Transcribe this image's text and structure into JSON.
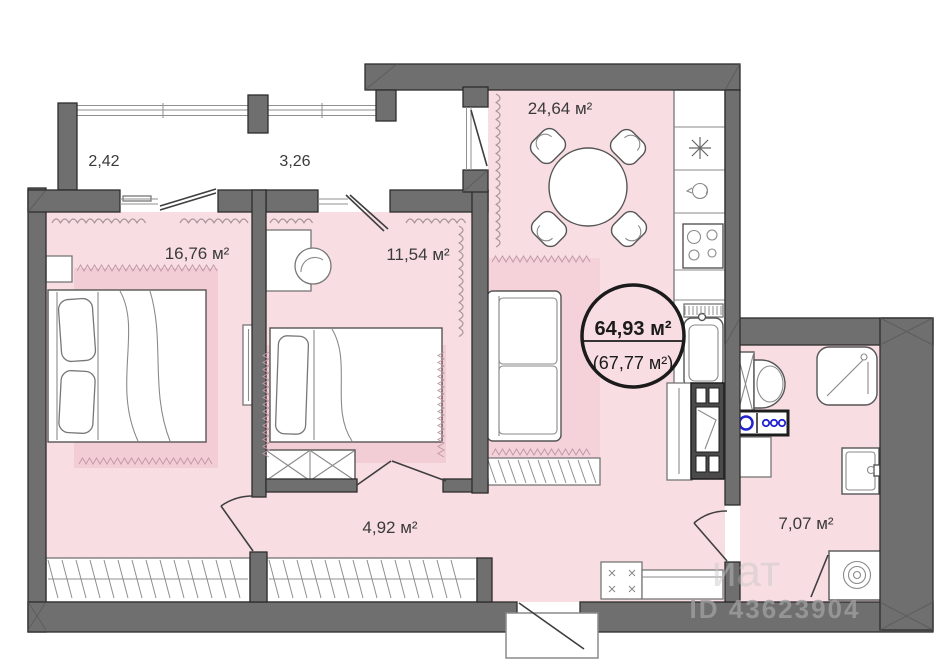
{
  "labels": {
    "balcony_left": "2,42",
    "balcony_right": "3,26",
    "bedroom1": "16,76 м²",
    "bedroom2": "11,54 м²",
    "kitchen": "24,64 м²",
    "hallway": "4,92 м²",
    "bathroom": "7,07 м²"
  },
  "badge": {
    "area_main": "64,93 м²",
    "area_secondary": "(67,77 м²)"
  },
  "watermark": {
    "word_fragment": "иат",
    "id_text": "ID 43623904"
  },
  "colors": {
    "wall": "#6f6f6f",
    "wall_stroke": "#2c2c2c",
    "floor_pink": "#f8dde3",
    "rug_pink": "#f3cdd6",
    "curtain": "#a89598",
    "fringe": "#c29aa6",
    "hatch": "#8f8f8f",
    "accent_blue": "#2323cf"
  }
}
